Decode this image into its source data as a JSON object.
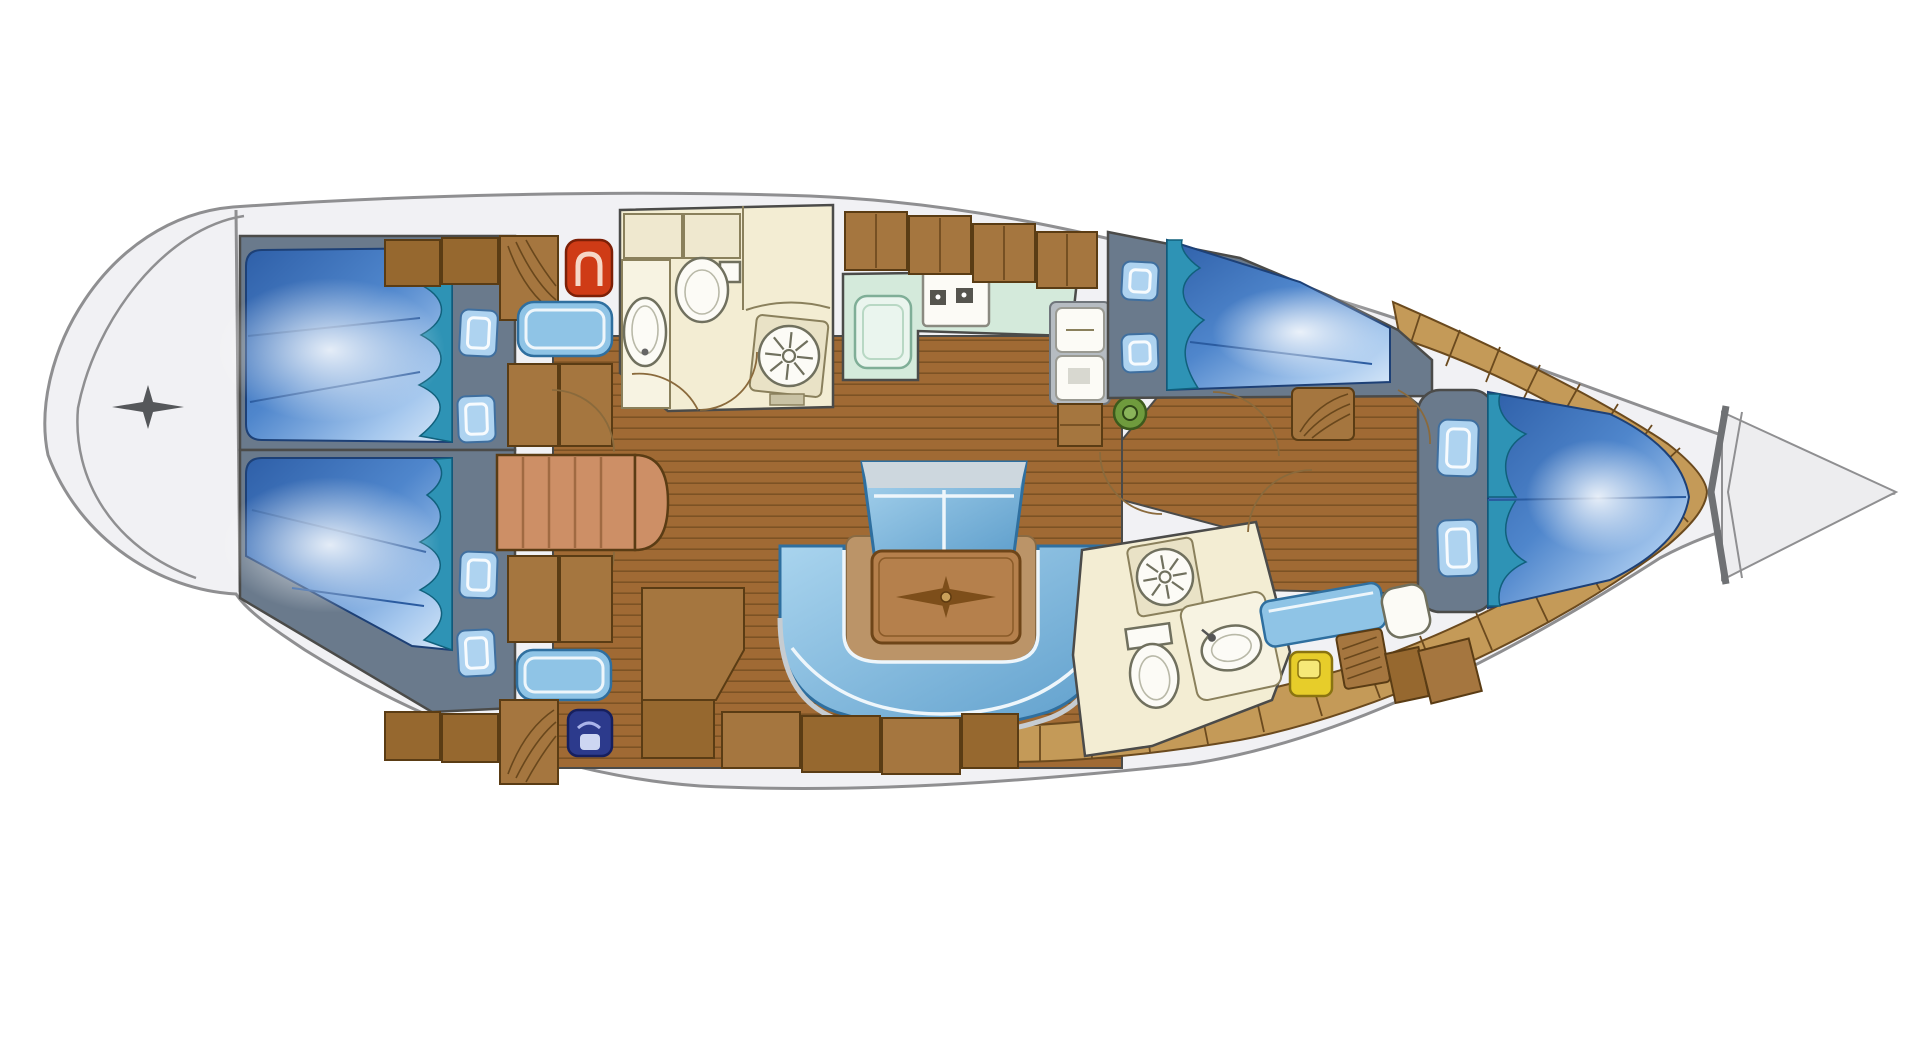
{
  "meta": {
    "diagram_type": "sailing-yacht interior floor plan, top-down view",
    "orientation": {
      "bow": "right",
      "stern": "left"
    },
    "visible_text": "none"
  },
  "colors": {
    "hull_fill": "#f1f1f4",
    "hull_line": "#8f8f91",
    "outline": "#4b4b49",
    "star": "#55575a",
    "chevron": "#6f7174",
    "wood": "#a06a34",
    "wood_line": "#5f3d17",
    "teak": "#c49a58",
    "teak_line": "#6b4a1e",
    "anchor_fill": "#ededef",
    "slate": "#6a7a8c",
    "bed_deep": "#2e5fa8",
    "bed_mid": "#4f86cc",
    "bed_light": "#a6c8ee",
    "bed_pale": "#d8e8f8",
    "bed_edge": "#1d4076",
    "bed_slat": "#2a5ba0",
    "billow": "#2e93b5",
    "billow_dark": "#10607c",
    "pillow": "#aed3f0",
    "pillow_line": "#3f6f9f",
    "cabinet": "#a5763f",
    "cabinet_dark": "#96682f",
    "cabinet_line": "#5a3c14",
    "cream": "#f3edd3",
    "cream_cabinet": "#efe8cf",
    "cream_line": "#8a805c",
    "counter": "#f7f3e2",
    "tile": "#e9e2c6",
    "fixture": "#fcfbf6",
    "fixture_line": "#70705e",
    "mint": "#d4eadb",
    "mint_sink": "#eaf5ee",
    "burner": "#55544e",
    "steps": "#cd8f66",
    "steps_line": "#a06a42",
    "settee_light": "#a9d4ee",
    "settee_mid": "#5f9fcc",
    "settee_edge": "#2f6f9f",
    "rim_silver": "#c6ccd1",
    "bench_back": "#cdd7de",
    "seat_blue": "#8fc4e6",
    "tan": "#bb9468",
    "table_wood": "#b5804c",
    "table_edge": "#6e4518",
    "inlay": "#7d4e1a",
    "red_fixture": "#cf3b16",
    "navy_fixture": "#2c3a8c",
    "yellow_fixture": "#e7cd2a",
    "green_seat": "#6f9b3d",
    "nav_frame": "#b6bcc2",
    "door_arc": "#8a6a3c"
  },
  "rooms": [
    {
      "id": "swim-platform",
      "name": "Stern swim platform and transom",
      "features": [
        "transom-line",
        "star-marker"
      ]
    },
    {
      "id": "aft-cabin-port",
      "name": "Aft cabin port with double berth",
      "features": [
        "double-berth",
        "two-pillows",
        "seat",
        "lockers",
        "louvered-locker",
        "red-washbasin"
      ]
    },
    {
      "id": "aft-cabin-starboard",
      "name": "Aft cabin starboard with double berth",
      "features": [
        "double-berth",
        "two-pillows",
        "seat",
        "lockers",
        "louvered-locker",
        "navy-washbasin"
      ]
    },
    {
      "id": "companionway",
      "name": "Companionway steps between aft cabins",
      "features": [
        "five-treads",
        "rounded-bottom-step",
        "cabin-door-arcs"
      ]
    },
    {
      "id": "aft-head",
      "name": "Aft head with WC shower and basin",
      "features": [
        "toilet",
        "round-basin",
        "shower-rosette",
        "counter",
        "door-arcs"
      ]
    },
    {
      "id": "galley",
      "name": "Galley with counters stove and sink",
      "features": [
        "mint-counter",
        "two-burner-stove",
        "sink",
        "overhead-lockers"
      ]
    },
    {
      "id": "nav-station",
      "name": "Navigation station with green stool",
      "features": [
        "instrument-boxes",
        "locker",
        "green-stool"
      ]
    },
    {
      "id": "salon",
      "name": "Salon with U-settee bench and table",
      "features": [
        "u-shaped-settee",
        "bench-seat",
        "table-with-compass-inlay",
        "wood-floor",
        "storage-boxes"
      ]
    },
    {
      "id": "pullman-cabin",
      "name": "Forward port cabin with double berth",
      "features": [
        "double-berth",
        "two-pillows",
        "louvered-dresser",
        "door-arc"
      ]
    },
    {
      "id": "forward-head",
      "name": "Forward head with WC shower and basin",
      "features": [
        "shower-rosette",
        "toilet",
        "oval-basin",
        "door-arc"
      ]
    },
    {
      "id": "bow-cabin",
      "name": "Bow cabin with V-berth and vanity seat",
      "features": [
        "v-berth",
        "two-pillows",
        "blue-seat",
        "white-cushion",
        "yellow-locker",
        "louvered-locker"
      ]
    },
    {
      "id": "anchor-locker",
      "name": "Bow anchor locker",
      "features": [
        "chevron-bulkhead"
      ]
    },
    {
      "id": "side-decks",
      "name": "Teak side decks around the bow",
      "features": [
        "plank-segments"
      ]
    },
    {
      "id": "corridor",
      "name": "Forward corridor with wood sole",
      "features": [
        "door-arcs"
      ]
    }
  ]
}
